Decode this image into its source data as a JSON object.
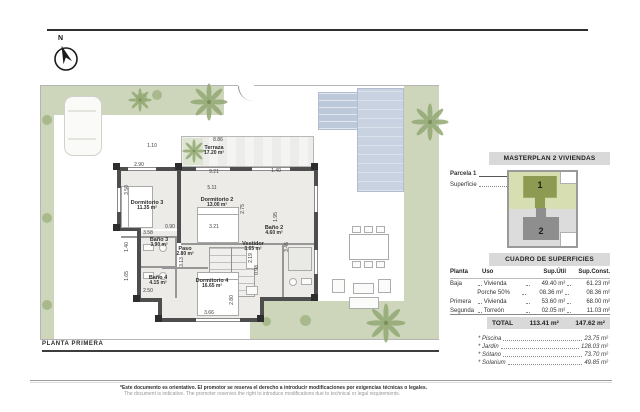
{
  "page": {
    "north_label": "N",
    "plan_title": "PLANTA PRIMERA",
    "disclaimer_es": "*Este documento es orientativo. El promotor se reserva el derecho a introducir modificaciones por exigencias técnicas o legales.",
    "disclaimer_en": "The document is indicative. The promoter reserves the right to introduce modifications due to technical or legal requirements."
  },
  "floorplan": {
    "rooms": [
      {
        "name": "Terraza",
        "area": "17.20 m²"
      },
      {
        "name": "Dormitorio 3",
        "area": "11.35 m²"
      },
      {
        "name": "Dormitorio 2",
        "area": "13.00 m²"
      },
      {
        "name": "Baño 3",
        "area": "3.90 m²"
      },
      {
        "name": "Paso",
        "area": "2.80 m²"
      },
      {
        "name": "Baño 4",
        "area": "4.15 m²"
      },
      {
        "name": "Dormitorio 4",
        "area": "16.65 m²"
      },
      {
        "name": "Vestidor",
        "area": "3.65 m²"
      },
      {
        "name": "Baño 2",
        "area": "4.60 m²"
      }
    ],
    "dimensions": [
      "8.86",
      "1.10",
      "2.90",
      "3.50",
      "9.21",
      "5.11",
      "1.40",
      "2.75",
      "1.95",
      "3.21",
      "0.90",
      "3.58",
      "1.40",
      "3.13",
      "2.19",
      "0.98",
      "3.45",
      "1.65",
      "2.50",
      "2.80",
      "3.66"
    ]
  },
  "sidebar": {
    "masterplan_title": "MASTERPLAN 2 VIVIENDAS",
    "parcela_label": "Parcela 1",
    "superficie_label": "Superficie",
    "superficie_value": "295.30 m²",
    "siteplan": {
      "plot1": "1",
      "plot2": "2"
    },
    "table_title": "CUADRO DE SUPERFICIES",
    "table": {
      "headers": [
        "Planta",
        "Uso",
        "Sup.Útil",
        "Sup.Const."
      ],
      "rows": [
        [
          "Baja",
          "Vivienda",
          "49.40 m²",
          "61.23 m²"
        ],
        [
          "",
          "Porche 50%",
          "08.36 m²",
          "08.36 m²"
        ],
        [
          "Primera",
          "Vivienda",
          "53.60 m²",
          "68.00 m²"
        ],
        [
          "Segunda",
          "Torreón",
          "02.05 m²",
          "11.03 m²"
        ]
      ],
      "total_label": "TOTAL",
      "total_util": "113.41 m²",
      "total_const": "147.62 m²"
    },
    "extras": [
      {
        "label": "* Piscina",
        "value": "23.75 m²"
      },
      {
        "label": "* Jardín",
        "value": "128.03 m²"
      },
      {
        "label": "* Sótano",
        "value": "73.70 m²"
      },
      {
        "label": "* Solarium",
        "value": "49.85 m²"
      }
    ]
  }
}
